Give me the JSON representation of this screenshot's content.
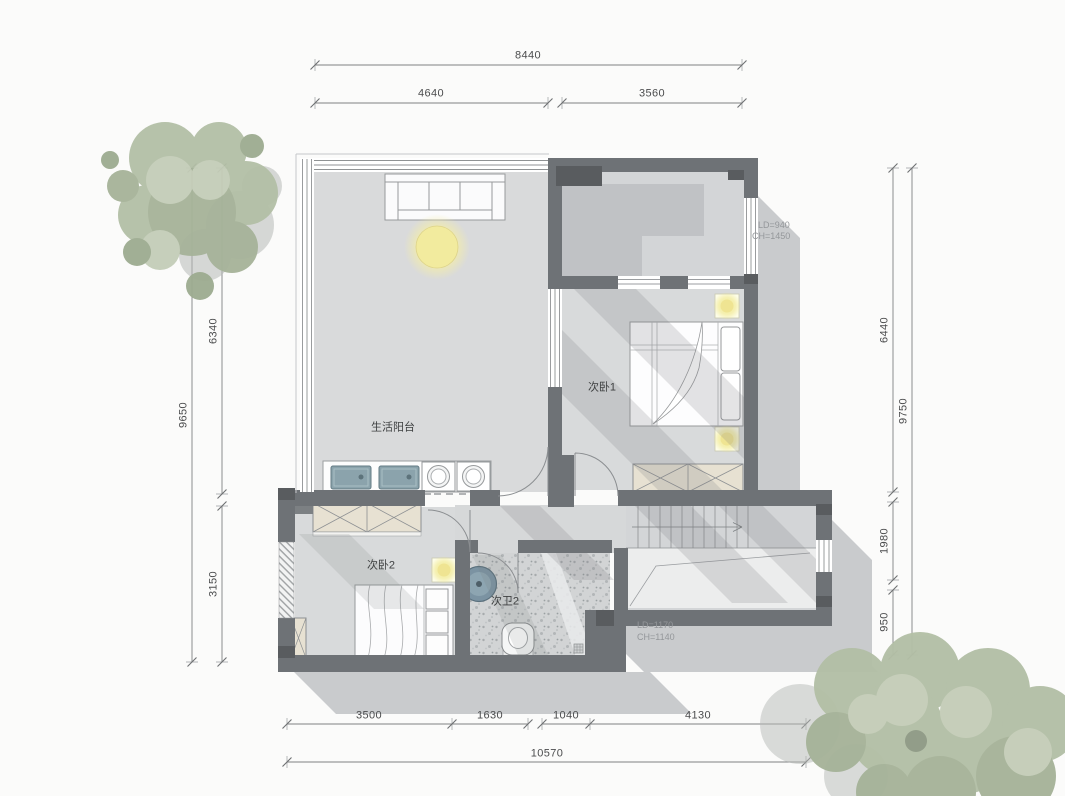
{
  "dimensions": {
    "top_total": "8440",
    "top_seg1": "4640",
    "top_seg2": "3560",
    "left_total": "9650",
    "left_seg1": "6340",
    "left_seg2": "3150",
    "right_total": "9750",
    "right_seg1": "6440",
    "right_seg2": "1980",
    "right_seg3": "950",
    "bottom_total": "10570",
    "bottom_seg1": "3500",
    "bottom_seg2": "1630",
    "bottom_seg3": "1040",
    "bottom_seg4": "4130"
  },
  "rooms": {
    "laundry_balcony": "生活阳台",
    "bedroom1": "次卧1",
    "bedroom2": "次卧2",
    "bathroom2": "次卫2"
  },
  "annotations": {
    "upper_window_ld": "LD=940",
    "upper_window_ch": "CH=1450",
    "lower_window_ld": "LD=1170",
    "lower_window_ch": "CH=1140"
  },
  "colors": {
    "wall": "#6e7276",
    "wall_dark": "#595c5f",
    "floor": "#d8dadb",
    "shadow_outer": "#c9cbcd",
    "cabinet_beige": "#e7e1d2",
    "light_yellow": "#f2eb9e",
    "fixture_teal": "#8ba3ac",
    "foliage_green": "#aebba2"
  }
}
